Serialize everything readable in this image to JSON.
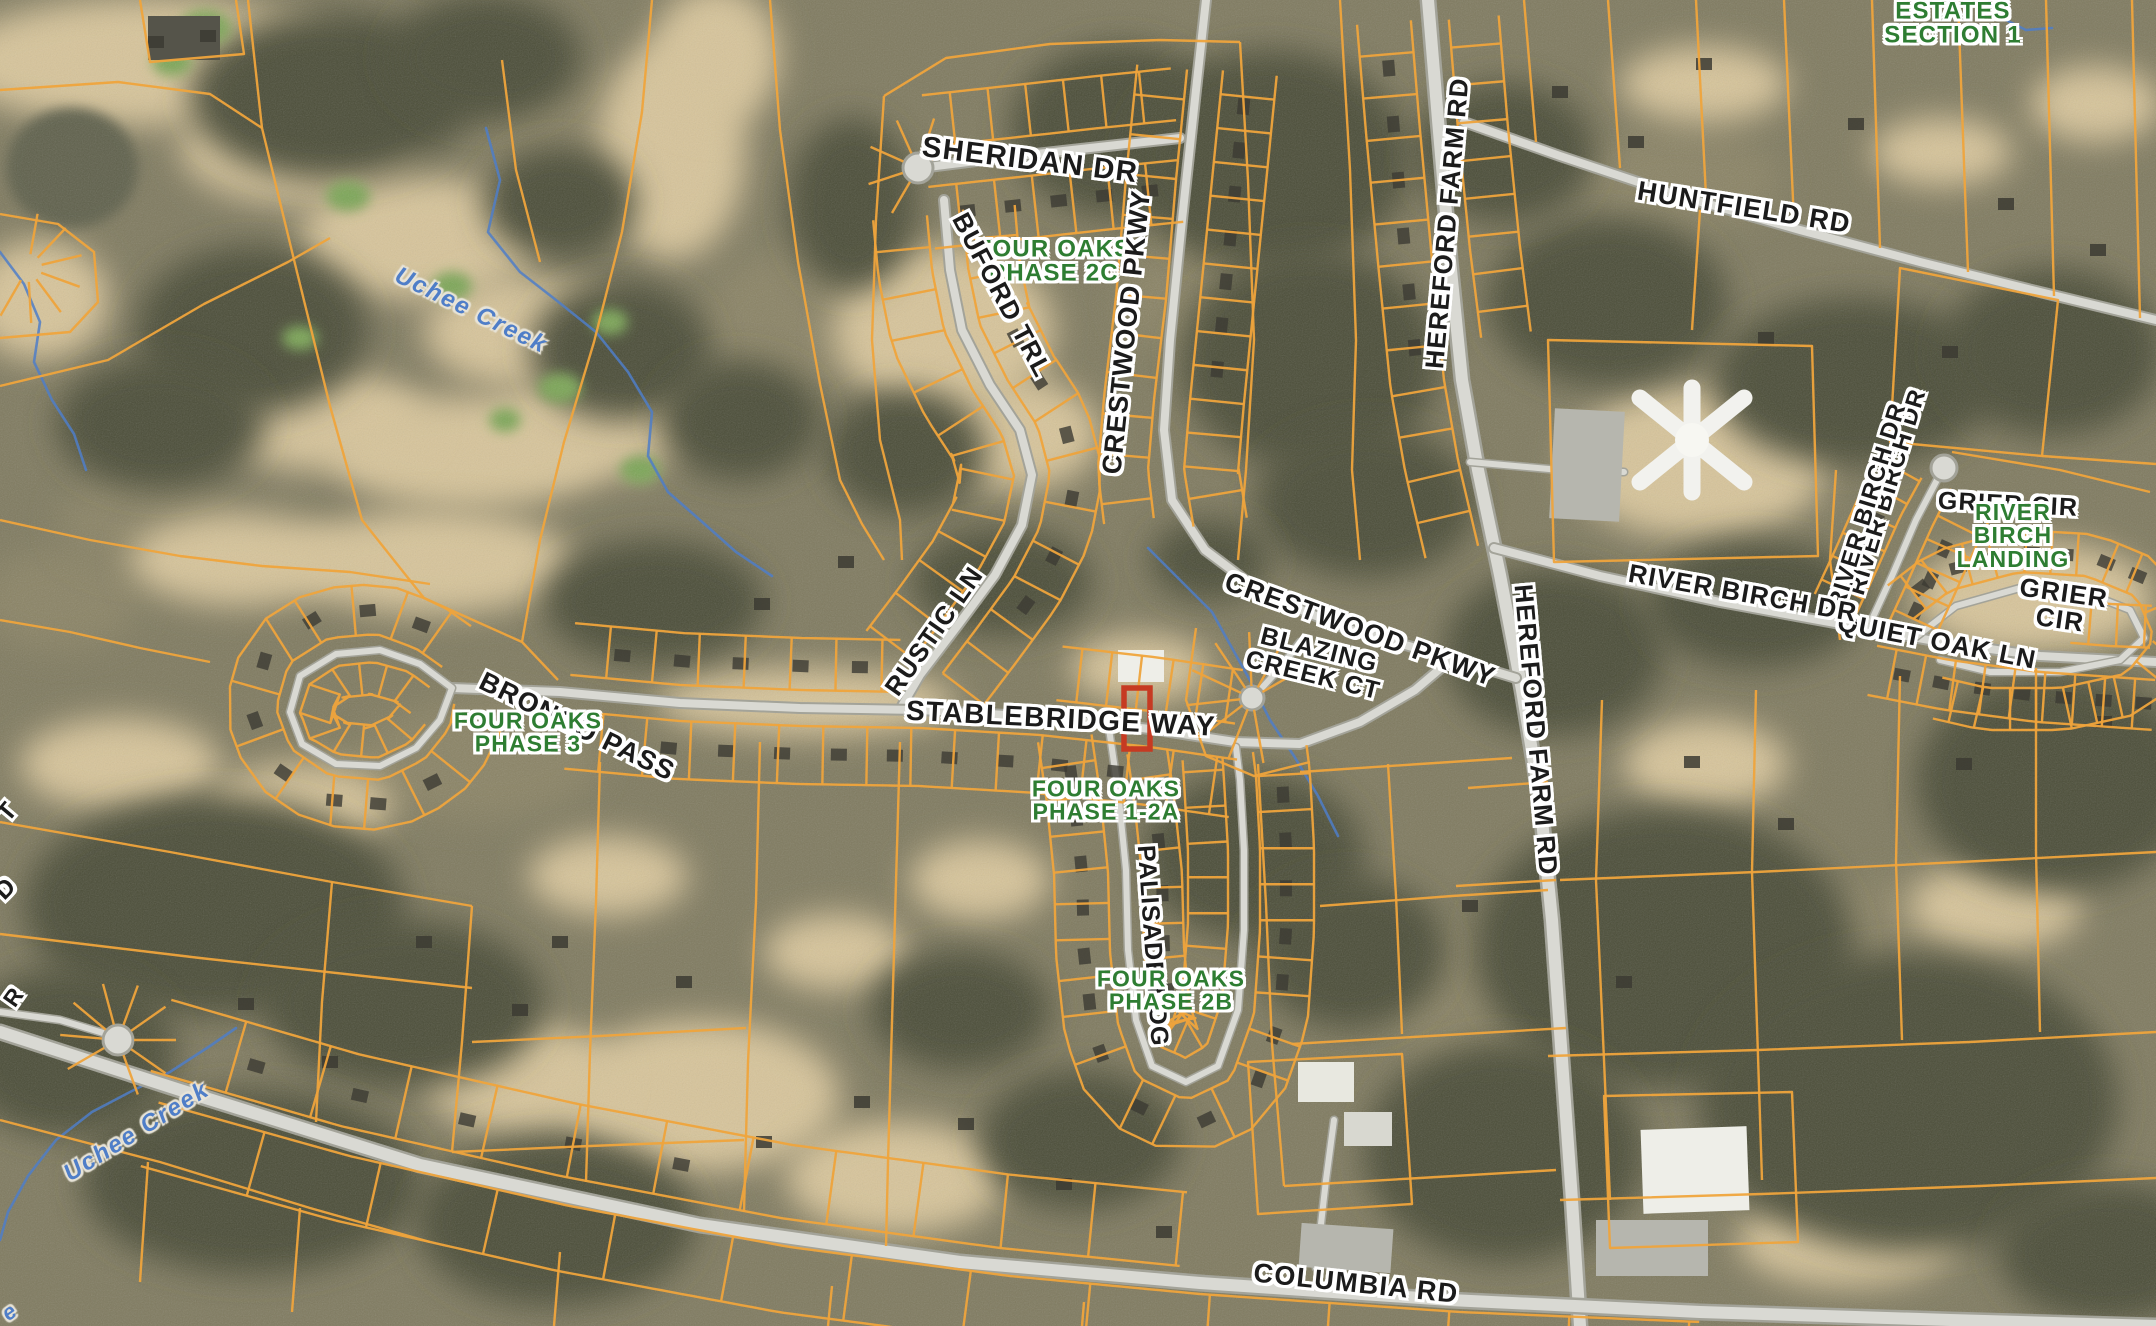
{
  "page": {
    "title": "County GIS Aerial Parcel Map"
  },
  "map": {
    "description": "Aerial imagery parcel map with orange lot boundaries, road name labels, subdivision phase labels and a selected parcel highlighted in red on Stablebridge Way",
    "colors": {
      "parcel_line": "#EFA43C",
      "selected_parcel_outline": "#C63A22",
      "road_label_text": "#1B1B1B",
      "subdivision_label_text": "#2E7D32",
      "water_label_text": "#4F7EC8",
      "water_line": "#4F7EC8"
    },
    "selected_parcel": {
      "street": "STABLEBRIDGE WAY"
    },
    "labels": [
      {
        "text": "SHERIDAN DR",
        "kind": "road",
        "x": 1030,
        "y": 161,
        "rot": 7,
        "size": 29
      },
      {
        "text": "FOUR OAKS\nPHASE 2C",
        "kind": "subdivision",
        "x": 1054,
        "y": 262,
        "rot": 0,
        "size": 24
      },
      {
        "text": "BUFORD TRL",
        "kind": "road",
        "x": 1002,
        "y": 295,
        "rot": 62,
        "size": 26
      },
      {
        "text": "CRESTWOOD PKWY",
        "kind": "road",
        "x": 1127,
        "y": 332,
        "rot": -84,
        "size": 27
      },
      {
        "text": "HEREFORD FARM RD",
        "kind": "road",
        "x": 1447,
        "y": 223,
        "rot": -85,
        "size": 26
      },
      {
        "text": "HUNTFIELD RD",
        "kind": "road",
        "x": 1744,
        "y": 208,
        "rot": 9,
        "size": 27
      },
      {
        "text": "ESTATES\nSECTION 1",
        "kind": "subdivision",
        "x": 1953,
        "y": 24,
        "rot": 0,
        "size": 24
      },
      {
        "text": "RIVER BIRCH DR",
        "kind": "road",
        "x": 1888,
        "y": 492,
        "rot": -73,
        "size": 24
      },
      {
        "text": "RIVER BIRCH DR",
        "kind": "road",
        "x": 1868,
        "y": 506,
        "rot": -73,
        "size": 24
      },
      {
        "text": "GRIER CIR",
        "kind": "road",
        "x": 2008,
        "y": 505,
        "rot": 3,
        "size": 25
      },
      {
        "text": "RIVER BIRCH\nLANDING",
        "kind": "subdivision",
        "x": 2013,
        "y": 536,
        "rot": 0,
        "size": 23
      },
      {
        "text": "GRIER CIR",
        "kind": "road",
        "x": 2062,
        "y": 606,
        "rot": 8,
        "size": 26
      },
      {
        "text": "QUIET OAK LN",
        "kind": "road",
        "x": 1937,
        "y": 641,
        "rot": 11,
        "size": 26
      },
      {
        "text": "RIVER BIRCH DR",
        "kind": "road",
        "x": 1743,
        "y": 593,
        "rot": 10,
        "size": 26
      },
      {
        "text": "CRESTWOOD PKWY",
        "kind": "road",
        "x": 1360,
        "y": 630,
        "rot": 20,
        "size": 27
      },
      {
        "text": "BLAZING\nCREEK CT",
        "kind": "road",
        "x": 1316,
        "y": 663,
        "rot": 14,
        "size": 25
      },
      {
        "text": "HEREFORD FARM RD",
        "kind": "road",
        "x": 1536,
        "y": 730,
        "rot": 85,
        "size": 26
      },
      {
        "text": "RUSTIC LN",
        "kind": "road",
        "x": 934,
        "y": 631,
        "rot": -55,
        "size": 26
      },
      {
        "text": "STABLEBRIDGE WAY",
        "kind": "road",
        "x": 1061,
        "y": 719,
        "rot": 3,
        "size": 28
      },
      {
        "text": "FOUR OAKS\nPHASE 1-2A",
        "kind": "subdivision",
        "x": 1106,
        "y": 801,
        "rot": 0,
        "size": 23
      },
      {
        "text": "PALISADE RDG",
        "kind": "road",
        "x": 1152,
        "y": 946,
        "rot": 86,
        "size": 25
      },
      {
        "text": "FOUR OAKS\nPHASE 2B",
        "kind": "subdivision",
        "x": 1171,
        "y": 991,
        "rot": 0,
        "size": 23
      },
      {
        "text": "BRONCO PASS",
        "kind": "road",
        "x": 577,
        "y": 727,
        "rot": 26,
        "size": 27
      },
      {
        "text": "FOUR OAKS\nPHASE 3",
        "kind": "subdivision",
        "x": 528,
        "y": 733,
        "rot": 0,
        "size": 23
      },
      {
        "text": "Uchee Creek",
        "kind": "water",
        "x": 471,
        "y": 311,
        "rot": 26,
        "size": 24
      },
      {
        "text": "Uchee Creek",
        "kind": "water",
        "x": 137,
        "y": 1132,
        "rot": -32,
        "size": 24
      },
      {
        "text": "COLUMBIA RD",
        "kind": "road",
        "x": 1356,
        "y": 1284,
        "rot": 6,
        "size": 27
      },
      {
        "text": "T",
        "kind": "road",
        "x": 8,
        "y": 812,
        "rot": -50,
        "size": 25
      },
      {
        "text": "D",
        "kind": "road",
        "x": 6,
        "y": 889,
        "rot": -45,
        "size": 25
      },
      {
        "text": "R",
        "kind": "road",
        "x": 14,
        "y": 997,
        "rot": -55,
        "size": 23
      },
      {
        "text": "e",
        "kind": "water",
        "x": 10,
        "y": 1312,
        "rot": -35,
        "size": 22
      }
    ]
  }
}
